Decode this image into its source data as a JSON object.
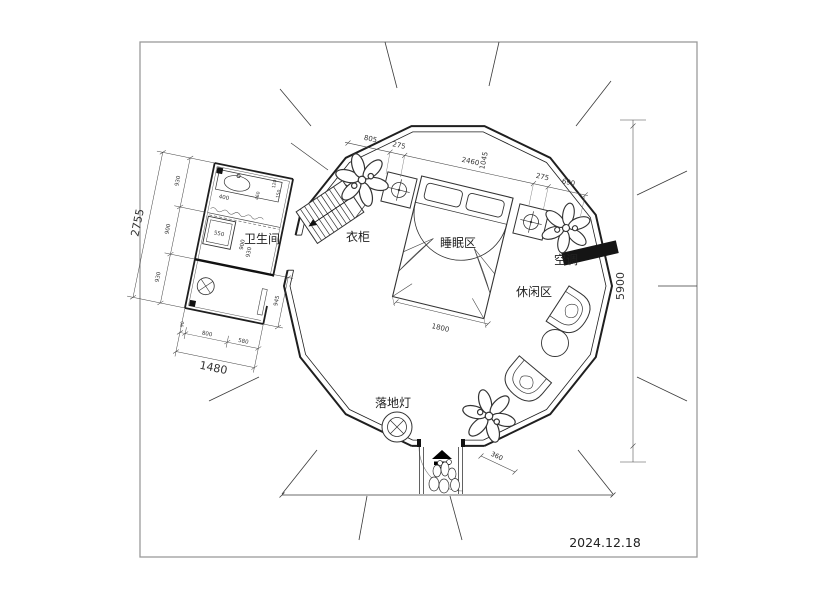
{
  "document": {
    "date": "2024.12.18"
  },
  "labels": {
    "bathroom": "卫生间",
    "wardrobe": "衣柜",
    "sleeping_area": "睡眠区",
    "leisure_area": "休闲区",
    "air_conditioner": "空调",
    "floor_lamp": "落地灯"
  },
  "dims": {
    "total_height": "5900",
    "top_chain": [
      "805",
      "275",
      "2460",
      "1045",
      "275",
      "690"
    ],
    "bed_width": "1800",
    "door_side": "360",
    "bath_total_h": "2755",
    "bath_total_w": "1480",
    "bath_left": [
      "930",
      "900",
      "930"
    ],
    "bath_bottom": [
      "90",
      "800",
      "580"
    ],
    "bath_inner": {
      "shower": "550",
      "mid_a": "900",
      "mid_b": "930",
      "right": "945",
      "sink": "400",
      "t1": "120",
      "t2": "150",
      "t3": "460"
    }
  },
  "colors": {
    "wall": "#1f1f1f",
    "dim": "#444444",
    "black_fill": "#111111",
    "frame": "#9a9a9a"
  }
}
